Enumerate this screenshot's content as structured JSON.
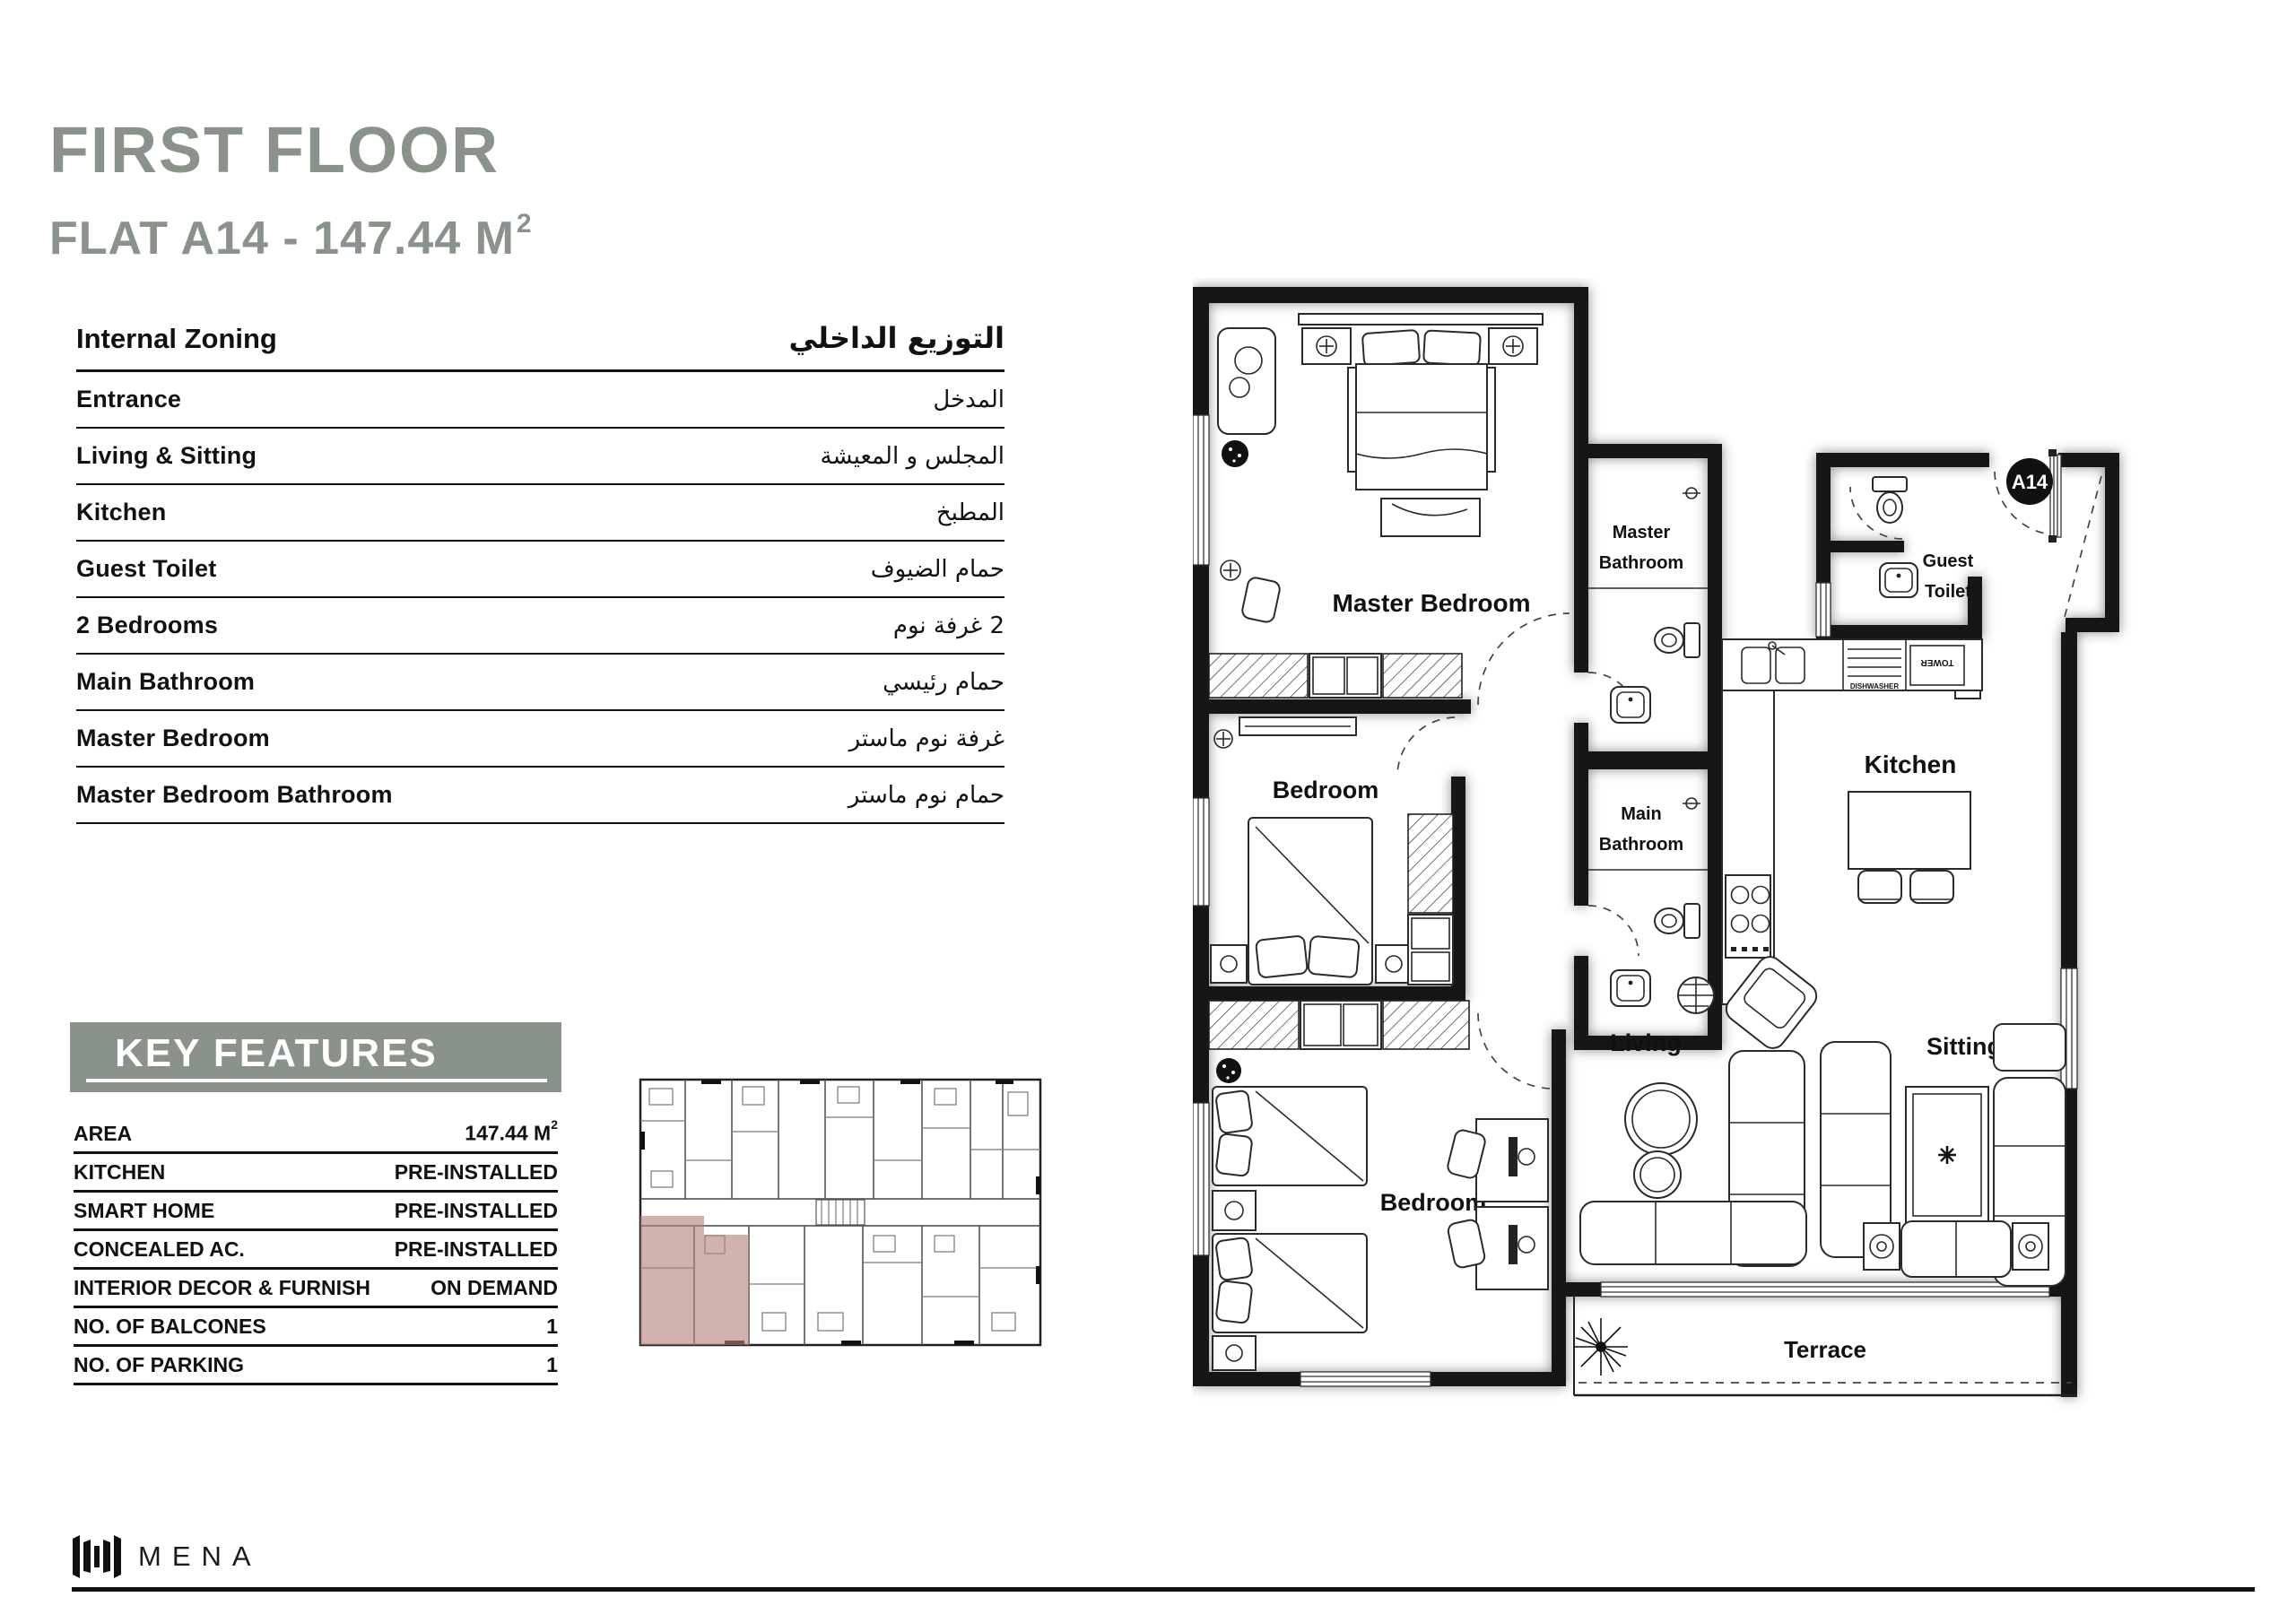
{
  "page": {
    "title": "FIRST FLOOR",
    "subtitle": "FLAT A14 - 147.44 M",
    "subtitle_sup": "2"
  },
  "internal_zoning": {
    "header_en": "Internal Zoning",
    "header_ar": "التوزيع الداخلي",
    "rows": [
      {
        "en": "Entrance",
        "ar": "المدخل"
      },
      {
        "en": "Living & Sitting",
        "ar": "المجلس و المعيشة"
      },
      {
        "en": "Kitchen",
        "ar": "المطبخ"
      },
      {
        "en": "Guest Toilet",
        "ar": "حمام الضيوف"
      },
      {
        "en": "2 Bedrooms",
        "ar": "2 غرفة نوم"
      },
      {
        "en": "Main Bathroom",
        "ar": "حمام رئيسي"
      },
      {
        "en": "Master Bedroom",
        "ar": "غرفة نوم ماستر"
      },
      {
        "en": "Master Bedroom Bathroom",
        "ar": "حمام نوم ماستر"
      }
    ]
  },
  "key_features": {
    "header": "KEY FEATURES",
    "rows": [
      {
        "label": "AREA",
        "value": "147.44 M",
        "sup": "2"
      },
      {
        "label": "KITCHEN",
        "value": "PRE-INSTALLED"
      },
      {
        "label": "SMART HOME",
        "value": "PRE-INSTALLED"
      },
      {
        "label": "CONCEALED AC.",
        "value": "PRE-INSTALLED"
      },
      {
        "label": "INTERIOR DECOR & FURNISH",
        "value": "ON DEMAND"
      },
      {
        "label": "NO. OF BALCONES",
        "value": "1"
      },
      {
        "label": "NO. OF PARKING",
        "value": "1"
      }
    ]
  },
  "floor_plan": {
    "badge": "A14",
    "labels": {
      "master_bedroom": "Master Bedroom",
      "master_bathroom": [
        "Master",
        "Bathroom"
      ],
      "main_bathroom": [
        "Main",
        "Bathroom"
      ],
      "guest_toilet": [
        "Guest",
        "Toilet"
      ],
      "kitchen": "Kitchen",
      "bedroom_middle": "Bedroom",
      "bedroom_lower": "Bedroom",
      "living": "Living",
      "sitting": "Sitting",
      "terrace": "Terrace",
      "dishwasher": "DISHWASHER",
      "tower": "TOWER"
    }
  },
  "footer": {
    "brand": "MENA"
  },
  "colors": {
    "accent": "#8a9389",
    "highlight": "#b5837b"
  }
}
